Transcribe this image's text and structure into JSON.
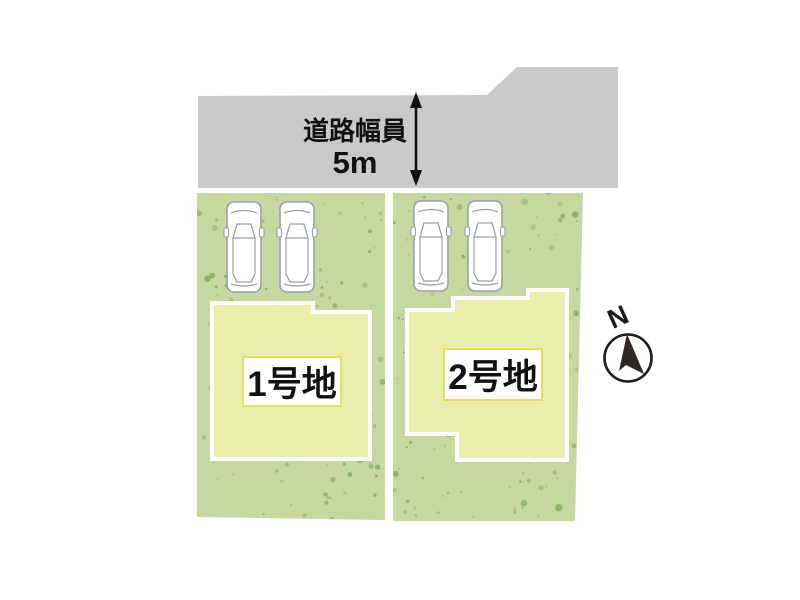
{
  "road": {
    "label": "道路幅員",
    "width_value": "5m"
  },
  "lots": [
    {
      "name": "1号地"
    },
    {
      "name": "2号地"
    }
  ],
  "compass": {
    "north": "N"
  },
  "vehicles": {
    "parked_car_count": 4
  },
  "colors": {
    "road": "#c9c9cc",
    "lot_green": "#c6d8a0",
    "speckle_green": "#7fa95c",
    "building_cream": "#e9eeac",
    "label_box_border": "#dfe259",
    "car_outline": "#9aa0a6",
    "text": "#111111"
  }
}
